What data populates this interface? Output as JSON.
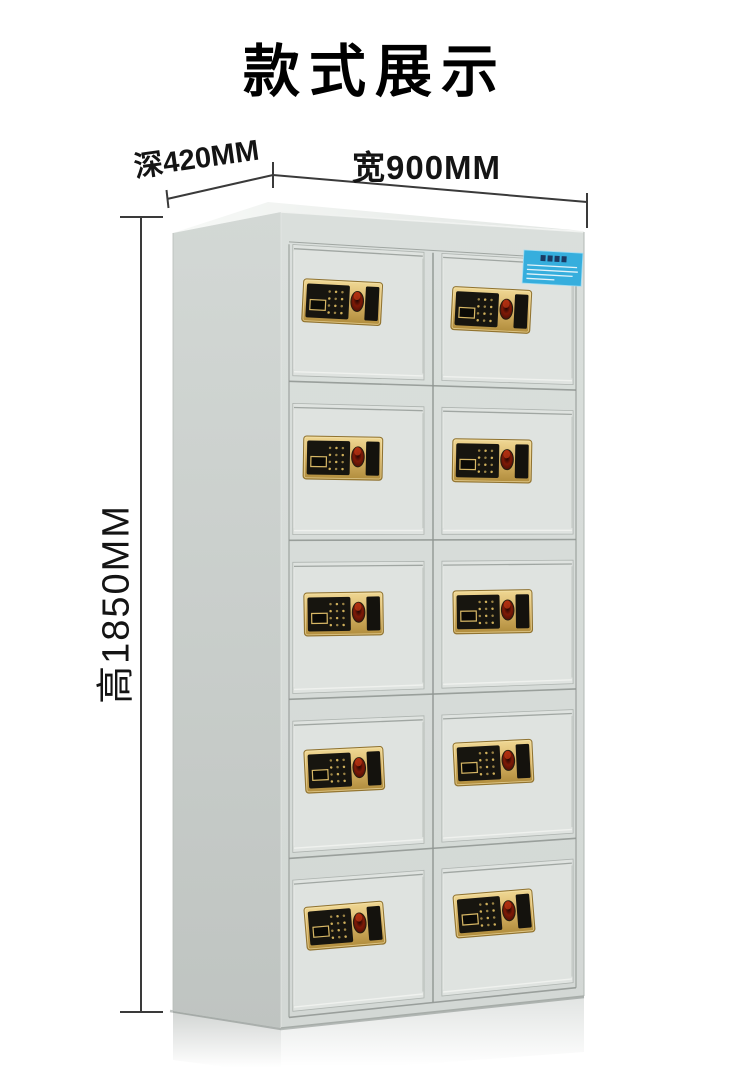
{
  "page": {
    "title": "款式展示",
    "background_color": "#ffffff"
  },
  "dimension_annotations": {
    "depth": "深420MM",
    "width": "宽900MM",
    "height": "高1850MM"
  },
  "cabinet": {
    "type": "electronic-fingerprint-locker-cabinet",
    "door_rows": 5,
    "door_columns": 2,
    "door_count": 10,
    "lock": {
      "keypad_rows": 4,
      "keypad_columns": 3
    },
    "colors": {
      "front_frame": "#d6dbd8",
      "door_panel": "#dfe3e0",
      "side_face": "#c7ccc9",
      "top_face": "#eff1ef",
      "seam": "#8f9591",
      "lock_plate_gold": "#d6b264",
      "lock_panel_black": "#17150f",
      "fingerprint_red": "#7e1a07",
      "label_blue": "#36aedd",
      "dimension_line": "#3a3a3a"
    }
  }
}
